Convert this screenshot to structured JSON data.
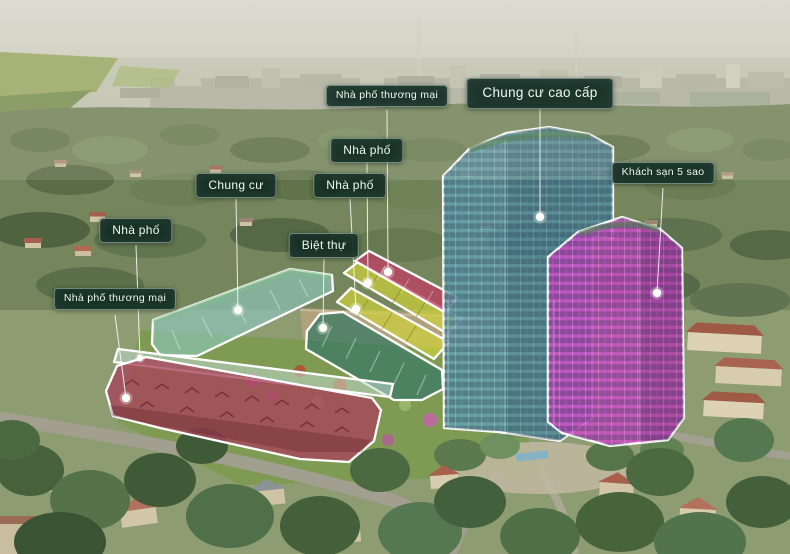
{
  "project_overview": {
    "labels": [
      {
        "id": "shophouse-commercial-top",
        "text": "Nhà phố thương mại"
      },
      {
        "id": "premium-apartment",
        "text": "Chung cư cao cấp"
      },
      {
        "id": "townhouse-upper",
        "text": "Nhà phố"
      },
      {
        "id": "townhouse-lower",
        "text": "Nhà phố"
      },
      {
        "id": "apartment",
        "text": "Chung cư"
      },
      {
        "id": "townhouse-left",
        "text": "Nhà phố"
      },
      {
        "id": "villa",
        "text": "Biệt thự"
      },
      {
        "id": "shophouse-commercial-left",
        "text": "Nhà phố thương mại"
      },
      {
        "id": "five-star-hotel",
        "text": "Khách sạn 5 sao"
      }
    ],
    "label_style": {
      "background": "#112c24",
      "text_color": "#f2f7f3",
      "border": "#bcd4c6"
    },
    "zones": {
      "apartment_tower": {
        "color": "#63a0b2",
        "opacity": "0.82"
      },
      "hotel_tower": {
        "color": "#cb4ec6",
        "opacity": "0.85"
      },
      "shophouse_row": {
        "color": "#a8435a",
        "opacity": "0.78"
      },
      "townhouse_strip_back": {
        "color": "#bfd9cd",
        "opacity": "0.55"
      },
      "apartment_block": {
        "color": "#8ec6bc",
        "opacity": "0.65"
      },
      "villa_strip": {
        "color": "#3e7b63",
        "opacity": "0.78"
      },
      "townhouse_strip_upper": {
        "color": "#cdd03c",
        "opacity": "0.72"
      },
      "townhouse_strip_lower": {
        "color": "#cdd03c",
        "opacity": "0.72"
      },
      "shophouse_strip_top": {
        "color": "#bc3f63",
        "opacity": "0.78"
      }
    }
  }
}
